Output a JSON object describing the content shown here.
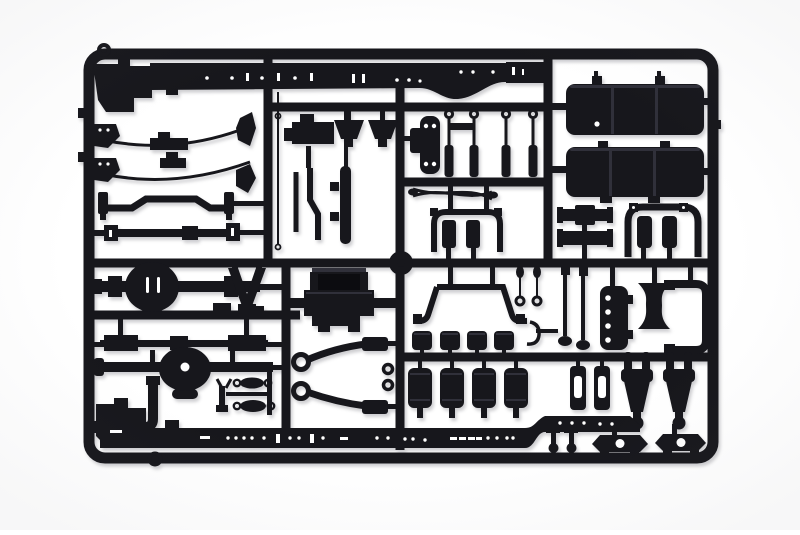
{
  "scene": {
    "type": "product photo",
    "description": "Black injection-molded plastic model kit sprue (parts tree) with truck chassis components, photographed on a white background",
    "background_color": "#ffffff"
  },
  "colors": {
    "background": "#ffffff",
    "plastic": "#17171c",
    "plastic_highlight": "#30303a",
    "plastic_deep": "#0c0c10",
    "hole": "#ffffff",
    "shadow": "rgba(30,30,45,0.22)"
  },
  "sprue": {
    "material": "black styrene plastic",
    "parts": [
      {
        "name": "sprue-frame",
        "qty": 1
      },
      {
        "name": "runner-grid",
        "qty": 1
      },
      {
        "name": "chassis-rail-upper",
        "qty": 1
      },
      {
        "name": "chassis-rail-lower",
        "qty": 1
      },
      {
        "name": "leaf-spring",
        "qty": 2
      },
      {
        "name": "anti-roll-bar",
        "qty": 1
      },
      {
        "name": "drive-shaft",
        "qty": 1
      },
      {
        "name": "rear-axle-with-differential",
        "qty": 1
      },
      {
        "name": "front-axle-with-hub",
        "qty": 1
      },
      {
        "name": "fuel-tank-half",
        "qty": 2
      },
      {
        "name": "bumper-bar",
        "qty": 2
      },
      {
        "name": "engine-block",
        "qty": 1
      },
      {
        "name": "cab-mount-frame",
        "qty": 1
      },
      {
        "name": "shock-absorber",
        "qty": 4
      },
      {
        "name": "air-reservoir-small",
        "qty": 4
      },
      {
        "name": "air-reservoir-large",
        "qty": 4
      },
      {
        "name": "u-bracket-with-cylinders",
        "qty": 2
      },
      {
        "name": "mounting-plate-with-holes",
        "qty": 2
      },
      {
        "name": "x-crossmember",
        "qty": 1
      },
      {
        "name": "c-bracket",
        "qty": 1
      },
      {
        "name": "steering-knuckle-fork",
        "qty": 2
      },
      {
        "name": "small-fork-pin",
        "qty": 2
      },
      {
        "name": "stabilizer-link",
        "qty": 2
      },
      {
        "name": "ladder-bar",
        "qty": 1
      },
      {
        "name": "tie-rod-dumbbell",
        "qty": 2
      },
      {
        "name": "exhaust-pipe",
        "qty": 1
      },
      {
        "name": "v-torque-arm",
        "qty": 1
      },
      {
        "name": "pendant-rod",
        "qty": 2
      },
      {
        "name": "hook-pipe",
        "qty": 1
      },
      {
        "name": "bottom-bracket-with-hole",
        "qty": 2
      },
      {
        "name": "corner-mount-block",
        "qty": 2
      },
      {
        "name": "hanger-ring",
        "qty": 2
      },
      {
        "name": "sprue-gate-ring",
        "qty": 1
      },
      {
        "name": "lever-rod",
        "qty": 2
      },
      {
        "name": "wishbone-rod",
        "qty": 1
      },
      {
        "name": "funnel-mount",
        "qty": 2
      },
      {
        "name": "antenna-rod",
        "qty": 1
      },
      {
        "name": "slot-bracket",
        "qty": 2
      }
    ]
  }
}
